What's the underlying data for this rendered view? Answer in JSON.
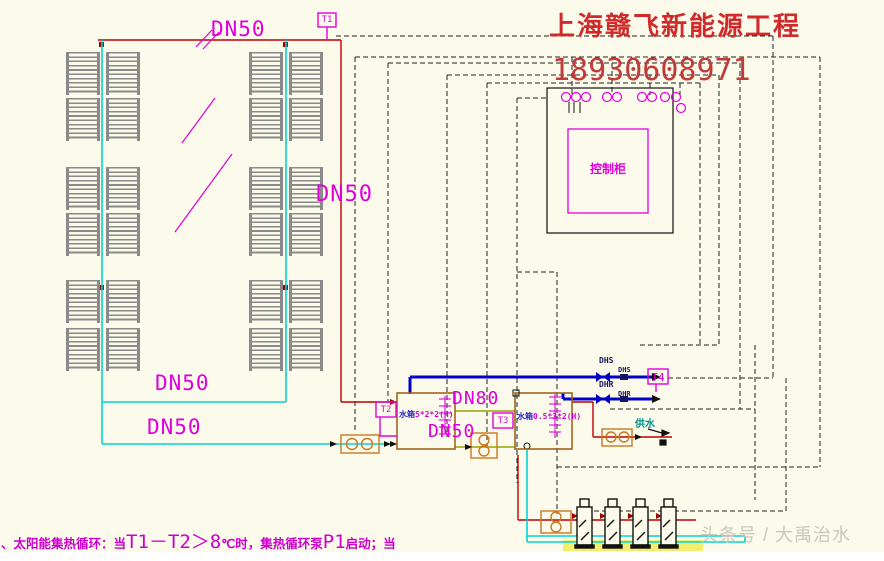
{
  "company": {
    "name": "上海赣飞新能源工程",
    "phone": "18930608971"
  },
  "watermark": "头条号 / 大禹治水",
  "note": {
    "pre": "、太阳能集热循环：当",
    "formula": "T1－T2＞8",
    "mid": "℃时，集热循环泵",
    "pump": "P1",
    "end": "启动；当"
  },
  "cabinet": {
    "label": "控制柜"
  },
  "pipes": {
    "dn50_top": "DN50",
    "dn50_right": "DN50",
    "dn50_mid": "DN50",
    "dn50_low": "DN50",
    "dn80": "DN80",
    "dn50_between": "DN50"
  },
  "sensors": {
    "t1": "T1",
    "t2": "T2",
    "t3": "T3",
    "t4": "T4"
  },
  "tanks": {
    "tank1": {
      "prefix": "水箱",
      "spec": "5*2*2(H)"
    },
    "tank2": {
      "prefix": "水箱",
      "spec": "0.5*3*2(H)"
    }
  },
  "dhw": {
    "supply": "DHS",
    "supply_sub": "DHS",
    "return": "DHR",
    "return_sub": "DHR"
  },
  "outlet": {
    "label": "供水"
  },
  "colors": {
    "magenta": "#DD00DD",
    "red": "#C00000",
    "cyan": "#00D5D5",
    "blue": "#0000C8",
    "olive": "#A3B11F",
    "tank": "#A0651E",
    "pump": "#C87820",
    "title_red": "#CF2B2B"
  }
}
